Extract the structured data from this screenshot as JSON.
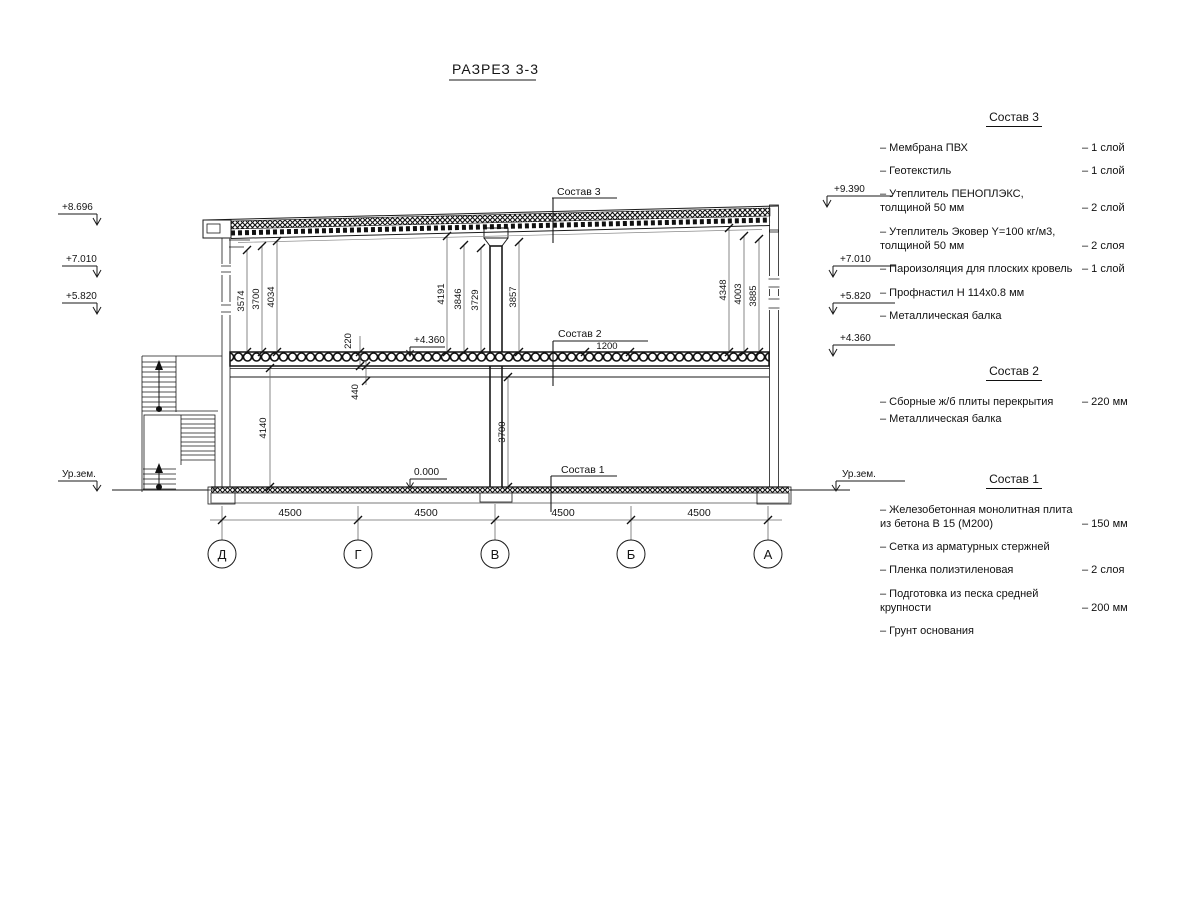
{
  "title": "РАЗРЕЗ 3-3",
  "section": {
    "marks_left": {
      "m1": "+8.696",
      "m2": "+7.010",
      "m3": "+5.820",
      "ground": "Ур.зем."
    },
    "marks_right": {
      "m1": "+9.390",
      "m2": "+7.010",
      "m3": "+5.820",
      "m4": "+4.360",
      "ground": "Ур.зем."
    },
    "marks_inner": {
      "floor2": "+4.360",
      "floor1": "0.000"
    },
    "leaders": {
      "l3": "Состав 3",
      "l2": "Состав 2",
      "l1": "Состав 1"
    },
    "dims_floor2_left": [
      "3574",
      "3700",
      "4034"
    ],
    "dims_floor2_mid": [
      "4191",
      "3846",
      "3729",
      "3857"
    ],
    "dims_floor2_right": [
      "4348",
      "4003",
      "3885"
    ],
    "dims_floor1": {
      "h_left": "4140",
      "h_col": "3700",
      "slab": "220",
      "beam": "440",
      "w": "1200"
    },
    "dims_bottom": [
      "4500",
      "4500",
      "4500",
      "4500"
    ],
    "axes": [
      "Д",
      "Г",
      "В",
      "Б",
      "А"
    ]
  },
  "legend3": {
    "title": "Состав 3",
    "items": [
      {
        "name": "– Мембрана ПВХ",
        "value": "– 1 слой"
      },
      {
        "name": "– Геотекстиль",
        "value": "– 1 слой"
      },
      {
        "name": "– Утеплитель ПЕНОПЛЭКС,\n  толщиной 50 мм",
        "value": "– 2 слой"
      },
      {
        "name": "– Утеплитель Эковер Y=100 кг/м3,\n  толщиной 50 мм",
        "value": "– 2 слоя"
      },
      {
        "name": "– Пароизоляция для плоских кровель",
        "value": "– 1 слой"
      },
      {
        "name": "– Профнастил Н 114х0.8 мм",
        "value": ""
      },
      {
        "name": "– Металлическая балка",
        "value": ""
      }
    ]
  },
  "legend2": {
    "title": "Состав 2",
    "items": [
      {
        "name": "– Сборные ж/б плиты перекрытия",
        "value": "– 220 мм"
      },
      {
        "name": "– Металлическая балка",
        "value": ""
      }
    ]
  },
  "legend1": {
    "title": "Состав 1",
    "items": [
      {
        "name": "– Железобетонная  монолитная плита\n  из бетона В 15 (М200)",
        "value": "– 150 мм"
      },
      {
        "name": "– Сетка из арматурных стержней",
        "value": ""
      },
      {
        "name": "– Пленка полиэтиленовая",
        "value": "–  2 слоя"
      },
      {
        "name": "– Подготовка из песка средней\n  крупности",
        "value": "– 200 мм"
      },
      {
        "name": "– Грунт основания",
        "value": ""
      }
    ]
  }
}
